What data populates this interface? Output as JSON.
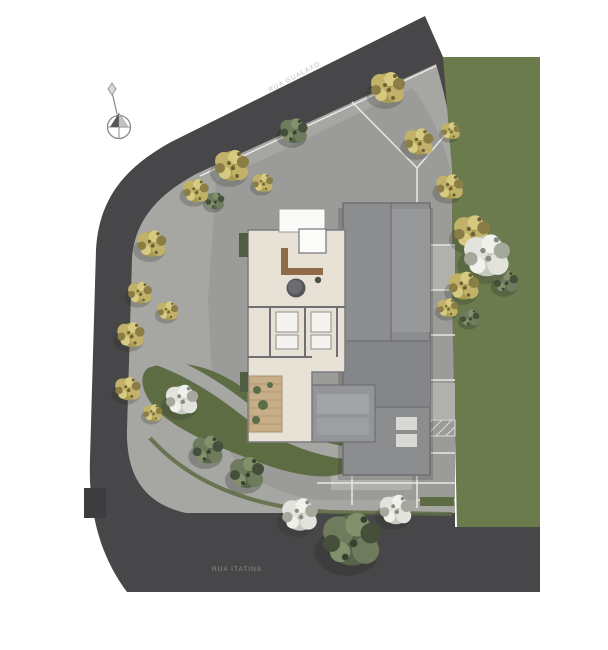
{
  "labels": {
    "street_top": "RUA GUALAXO",
    "street_bottom": "RUA ITATINS"
  },
  "icons": {
    "compass_north": "compass-north-icon",
    "accessible_parking_glyph": "♿"
  },
  "colors": {
    "road": "#474749",
    "sidewalk": "#a6a6a3",
    "paving": "#9b9b99",
    "parking_light": "#b0b0ad",
    "lawn": "#6c7b4d",
    "floor_beige": "#e8e1d5",
    "building_core": "#8c8d8f",
    "wall": "#6f7073",
    "deck_wood": "#c8ae88",
    "counter_wood": "#8f6b49",
    "planting_bed": "#5e6c44",
    "tree_yellow": "#b9a95f",
    "tree_green": "#5a684b",
    "tree_white": "#e6e6e2",
    "marking_white": "#e8e8e6"
  }
}
